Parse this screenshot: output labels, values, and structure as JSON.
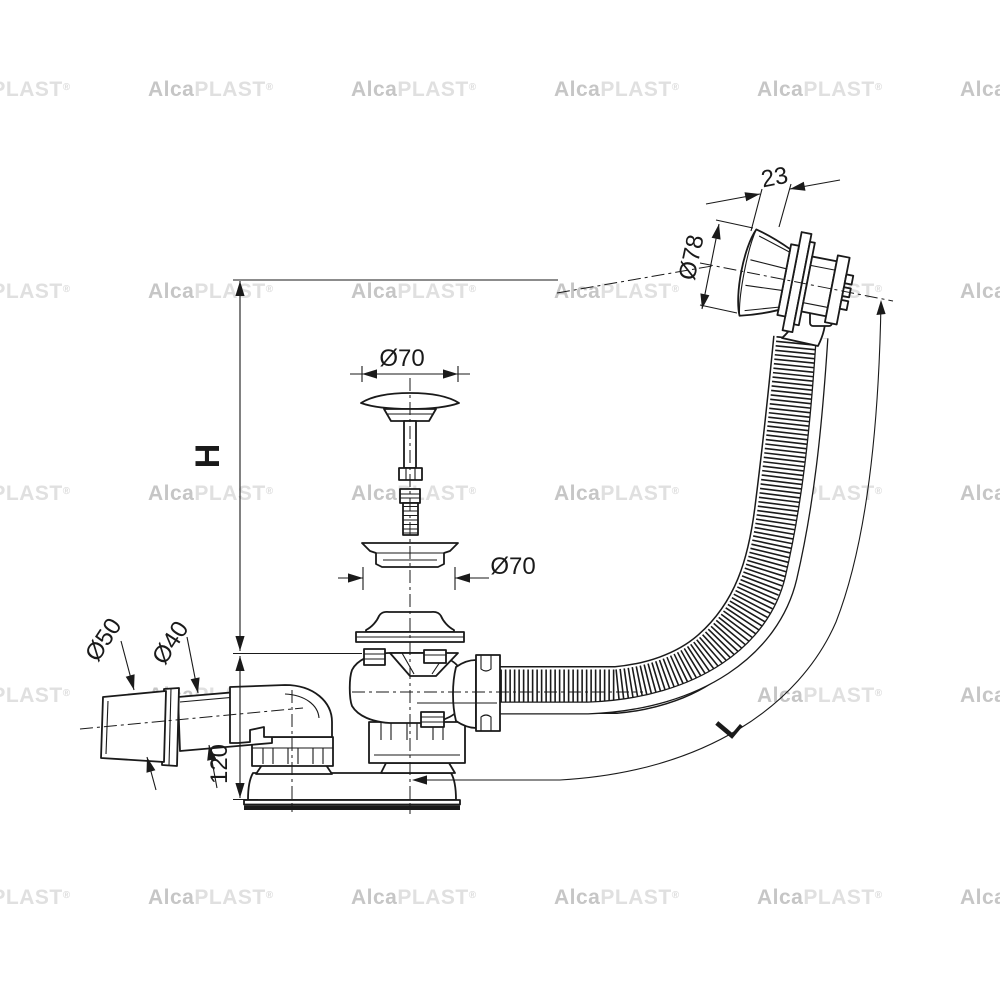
{
  "page": {
    "background": "#ffffff"
  },
  "drawing": {
    "type": "technical-line-drawing",
    "subject": "bath waste and overflow set with flexible hose, side view with dimensions",
    "dimensions": {
      "overflow_depth": "23",
      "overflow_diameter": "Ø78",
      "plug_diameter": "Ø70",
      "seal_diameter": "Ø70",
      "outlet_socket_diameter": "Ø50",
      "outlet_pipe_diameter": "Ø40",
      "trap_height": "120",
      "height_label": "H",
      "hose_length_label": "L"
    },
    "watermark": {
      "bold": "Alca",
      "light": "PLAST",
      "registered": "®"
    },
    "colors": {
      "line": "#1a1a1a",
      "watermark_bold": "#c6c6c6",
      "watermark_light": "#e0e0e0"
    }
  }
}
